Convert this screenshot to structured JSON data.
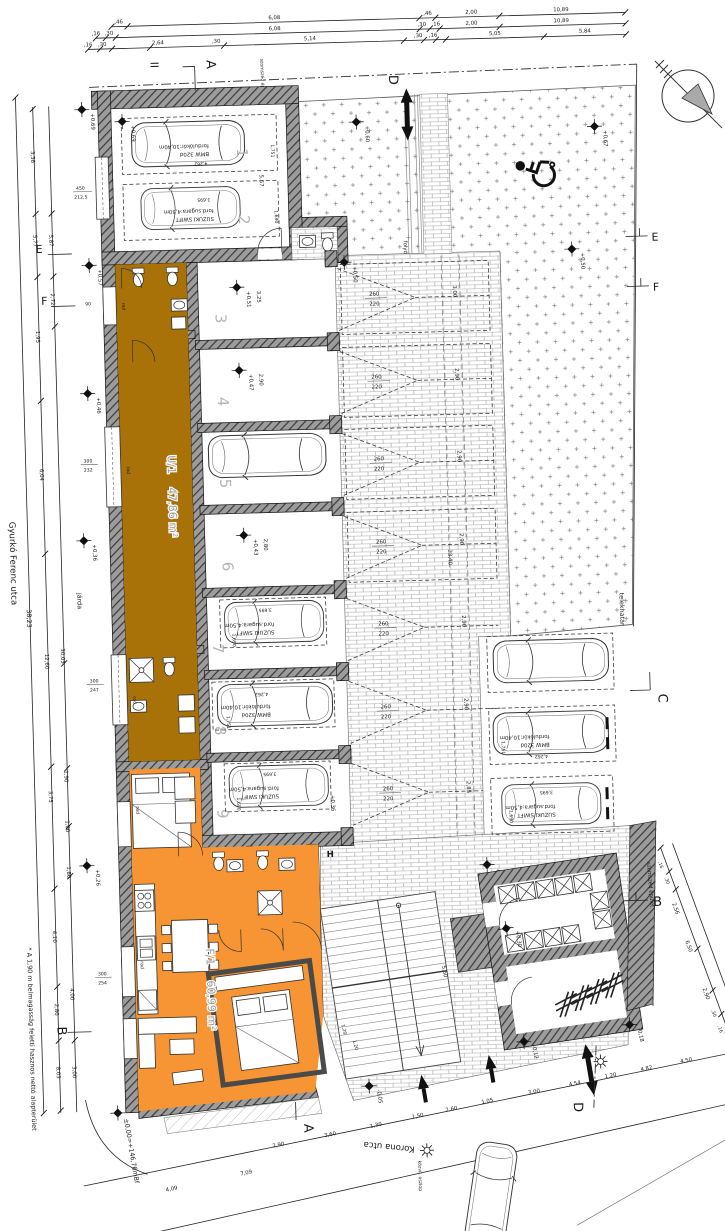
{
  "streets": {
    "left": "Gyurkó Ferenc utca",
    "bottom": "Korona utca",
    "sidewalk": "járda",
    "lamp_label": "közvil. oszlop"
  },
  "site": {
    "boundary_label": "telekhatár",
    "neighbor_label": "szomszéd épület",
    "neighbor_top_label": "szomszéd épület",
    "drain_label": "folyóka",
    "datum": "±0,00=+146,76mBf",
    "note": "* A 1,90 m belmagasság feletti hasznos nettó alapterület",
    "h_mark": "H"
  },
  "units": {
    "u1_name": "U/1",
    "u1_area": "47,86 m²",
    "f1_name": "F/1",
    "f1_area": "60,99 m²"
  },
  "cars": {
    "bmw_turn": "fordulókör:10,40m",
    "bmw_model": "BMW 320d",
    "suzuki_turn": "ford.sugara:4,50m",
    "suzuki_model": "SUZUKI SWIFT",
    "bmw_len": "4,262",
    "bmw_wid": "1,751",
    "suzuki_len": "3,695",
    "suzuki_wid": "1,690"
  },
  "sections": {
    "a": "A",
    "b": "B",
    "c": "C",
    "d": "D",
    "e": "E",
    "f": "F",
    "i": "II"
  },
  "stalls": {
    "numbers": [
      "1",
      "2",
      "3",
      "4",
      "5",
      "6",
      "7",
      "8",
      "9"
    ],
    "widths": [
      "3,25",
      "2,90",
      "2,90",
      "2,80",
      "2,85",
      "2,90",
      "2,85"
    ],
    "levels": [
      "+0,51",
      "+0,47",
      "+0,45",
      "+0,43",
      "+0,39",
      "+0,38",
      "+0,36"
    ],
    "depths": [
      "3,00",
      "2,90",
      "2,90",
      "2,90",
      "2,90",
      "2,90",
      "2,85"
    ],
    "door_w": "260",
    "door_h": "220"
  },
  "levels": {
    "hall": "+0,69",
    "entry": "+0,57",
    "l046": "+0,46",
    "l036": "+0,36",
    "l026": "+0,26",
    "yard_a": "+0,60",
    "yard_b": "+0,67",
    "yard_c": "+0,50",
    "lobby": "+0,50",
    "court": "+0,35",
    "store": "+0,30",
    "m005": "-0,05",
    "m012": "-0,12",
    "m018": "-0,18"
  },
  "dims": {
    "top1": [
      ",46",
      "6,08",
      ",46",
      "2,00",
      "10,89"
    ],
    "top2": [
      ",16",
      ",30",
      "6,08",
      ",30",
      ",16",
      "2,00",
      "10,89"
    ],
    "top3": [
      ",16",
      ",30",
      "2,64",
      ",30",
      "5,14",
      ",30",
      ",16",
      "5,05",
      "5,84"
    ],
    "left_total": "38,23",
    "left_a": [
      "3,38",
      "5,77",
      "1,95",
      "6,04",
      "12,60",
      "3,75",
      "4,10",
      "2,80",
      "8,03"
    ],
    "left_b": [
      "5,87",
      "2,72",
      "30,03",
      "1,90",
      "1,00",
      "1,80",
      "4,00",
      "3,00"
    ],
    "hall_depth": "5,57",
    "drive_total": "23,40",
    "drain": [
      "6,89",
      "6,19",
      "5,95"
    ],
    "right_chain": [
      ",16",
      ",30",
      "2,56",
      "6,50",
      "2,90",
      ",30",
      ",16"
    ],
    "street": [
      "4,09",
      "7,09",
      "2,90",
      "3,60",
      "1,30",
      "1,50",
      "2,60",
      "1,05",
      "3,00",
      "4,54",
      "1,20",
      "4,82",
      "4,50"
    ],
    "stairs": [
      "1,20",
      ",20",
      "1,20"
    ],
    "court": [
      "2,00",
      "4,50",
      "5,50"
    ]
  },
  "windows": {
    "hall_t": "450",
    "hall_b": "212,5",
    "w90": "90",
    "a_t": "300",
    "a_b": "232",
    "b_t": "300",
    "b_b": "247",
    "c_t": "300",
    "c_b": "254"
  },
  "misc": {
    "rad": "rad"
  }
}
